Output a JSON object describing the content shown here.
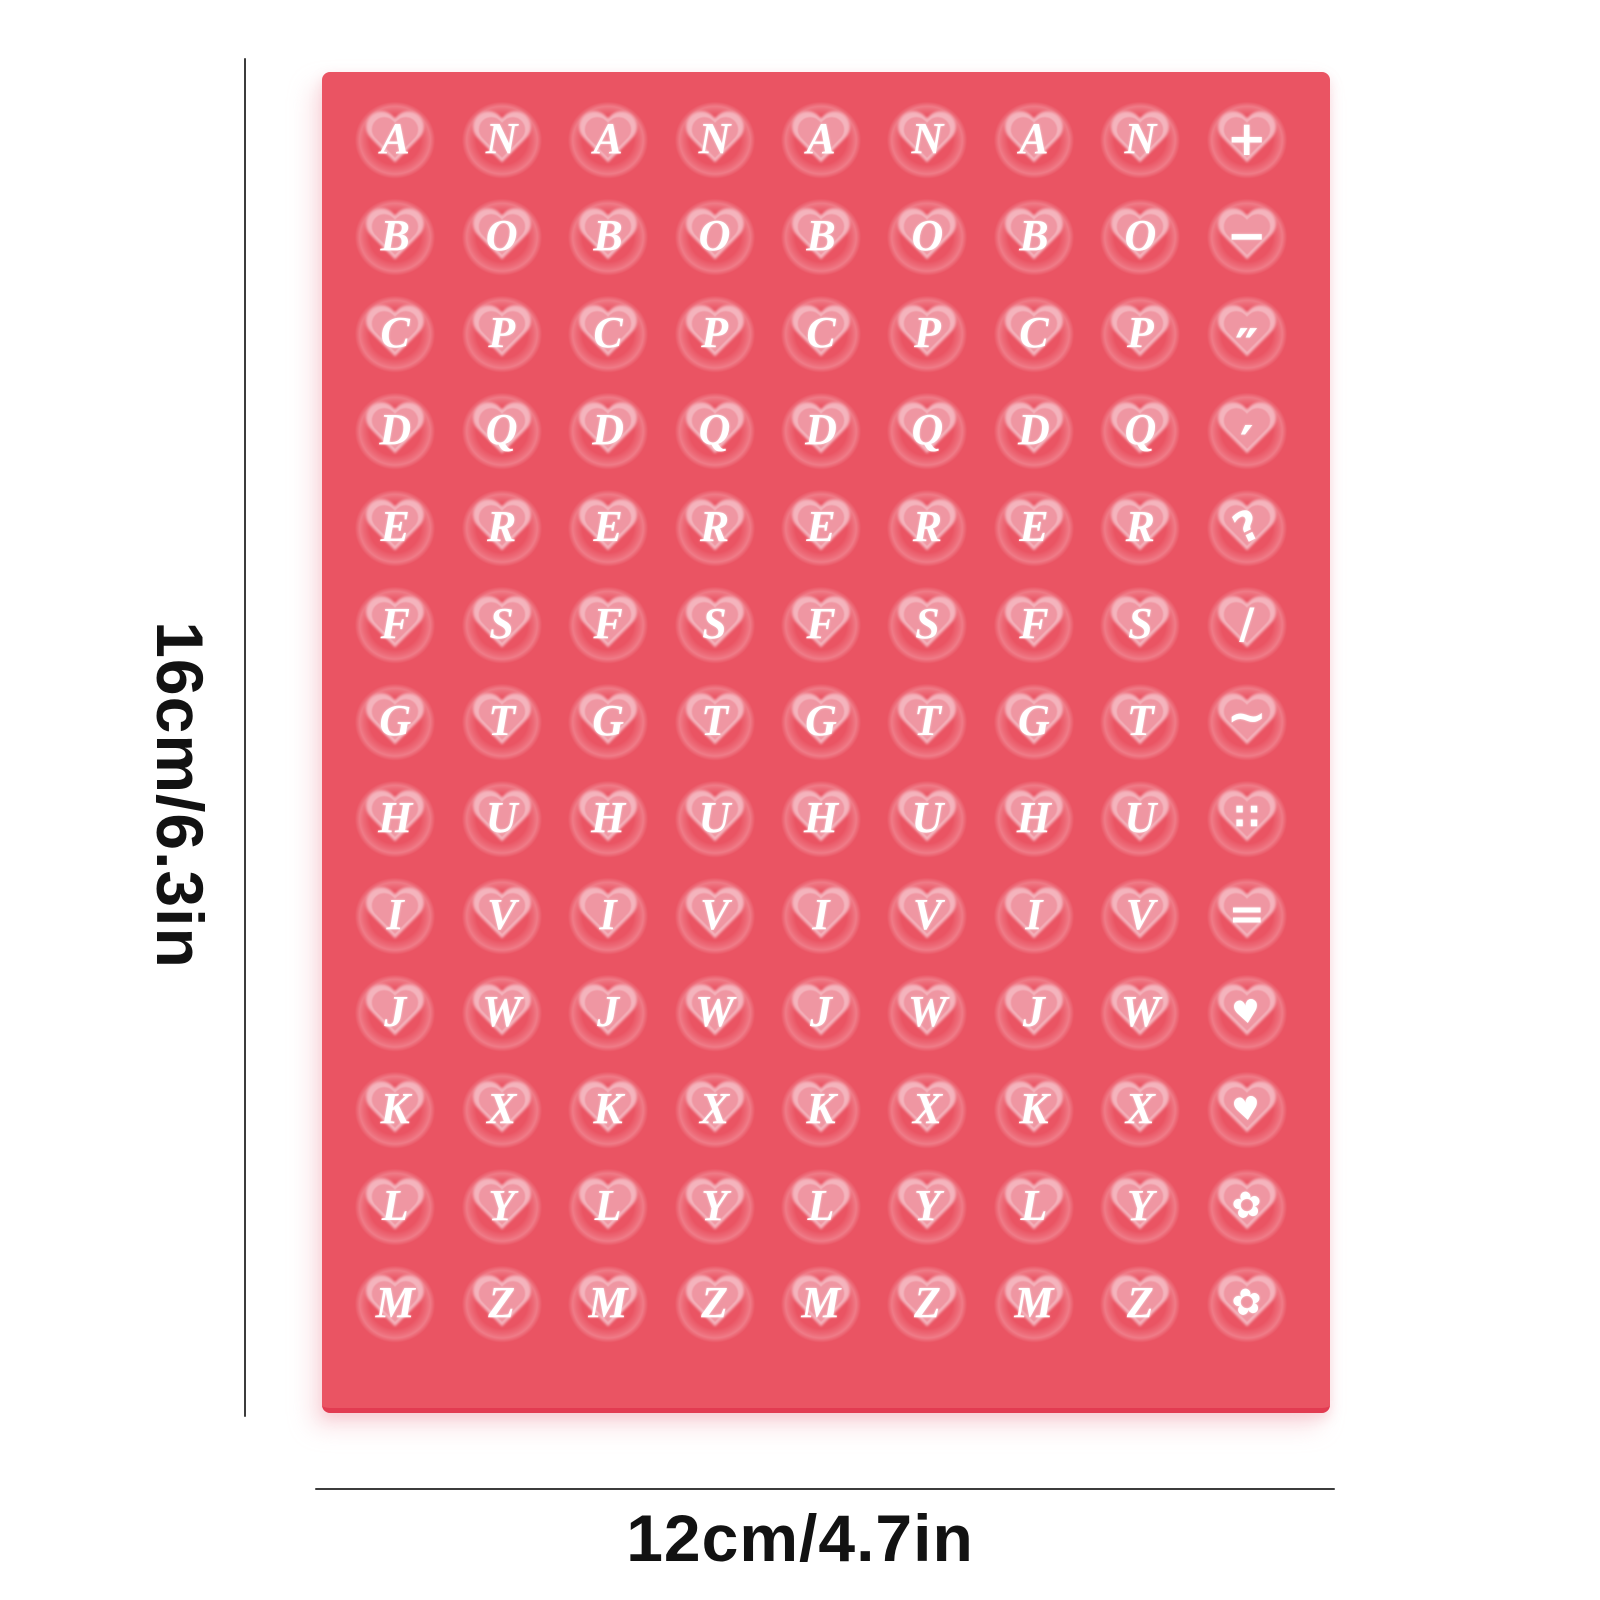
{
  "colors": {
    "page_bg": "#ffffff",
    "sheet_red": "#ea5463",
    "sheet_edge": "#e23b51",
    "heart_rim": "#f4b4bd",
    "heart_fill": "#ef96a2",
    "glyph_white": "#ffffff",
    "dim_line": "#3c3c3c",
    "dim_text": "#121212"
  },
  "dimensions": {
    "height_label": "16cm/6.3in",
    "width_label": "12cm/4.7in"
  },
  "sheet": {
    "grid": {
      "columns": 9,
      "rows": 13
    },
    "rows": [
      [
        "A",
        "N",
        "A",
        "N",
        "A",
        "N",
        "A",
        "N",
        "+"
      ],
      [
        "B",
        "O",
        "B",
        "O",
        "B",
        "O",
        "B",
        "O",
        "−"
      ],
      [
        "C",
        "P",
        "C",
        "P",
        "C",
        "P",
        "C",
        "P",
        "″"
      ],
      [
        "D",
        "Q",
        "D",
        "Q",
        "D",
        "Q",
        "D",
        "Q",
        "′"
      ],
      [
        "E",
        "R",
        "E",
        "R",
        "E",
        "R",
        "E",
        "R",
        "?"
      ],
      [
        "F",
        "S",
        "F",
        "S",
        "F",
        "S",
        "F",
        "S",
        "/"
      ],
      [
        "G",
        "T",
        "G",
        "T",
        "G",
        "T",
        "G",
        "T",
        "~"
      ],
      [
        "H",
        "U",
        "H",
        "U",
        "H",
        "U",
        "H",
        "U",
        "∷"
      ],
      [
        "I",
        "V",
        "I",
        "V",
        "I",
        "V",
        "I",
        "V",
        "="
      ],
      [
        "J",
        "W",
        "J",
        "W",
        "J",
        "W",
        "J",
        "W",
        "♥"
      ],
      [
        "K",
        "X",
        "K",
        "X",
        "K",
        "X",
        "K",
        "X",
        "♥"
      ],
      [
        "L",
        "Y",
        "L",
        "Y",
        "L",
        "Y",
        "L",
        "Y",
        "✿"
      ],
      [
        "M",
        "Z",
        "M",
        "Z",
        "M",
        "Z",
        "M",
        "Z",
        "✿"
      ]
    ]
  }
}
